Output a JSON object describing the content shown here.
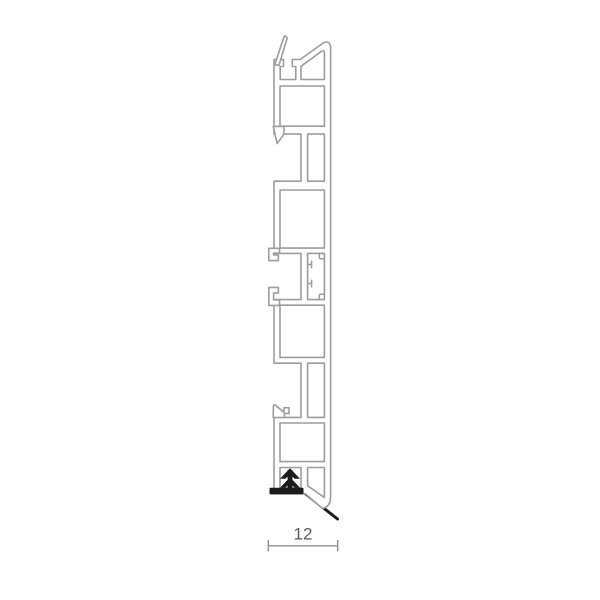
{
  "page": {
    "background_color": "#ffffff",
    "description": "Technical cross-section drawing of an extruded multi-chamber profile with bottom push-in gasket and width dimension"
  },
  "drawing": {
    "dimension": {
      "label": "12"
    },
    "icons": [
      {
        "name": "push-in-arrow-icon",
        "meaning": "insertion direction, double chevron up, black"
      },
      {
        "name": "gasket-lip-line",
        "meaning": "black flexible seal lip at bottom right"
      }
    ],
    "colors": {
      "profile_outline": "#9c9c9c",
      "profile_fill": "#ffffff",
      "gasket_black": "#1b1b1b",
      "dimension_color": "#8f8f8f",
      "dimension_text_color": "#5a5a5a",
      "page_bg": "#ffffff"
    }
  }
}
